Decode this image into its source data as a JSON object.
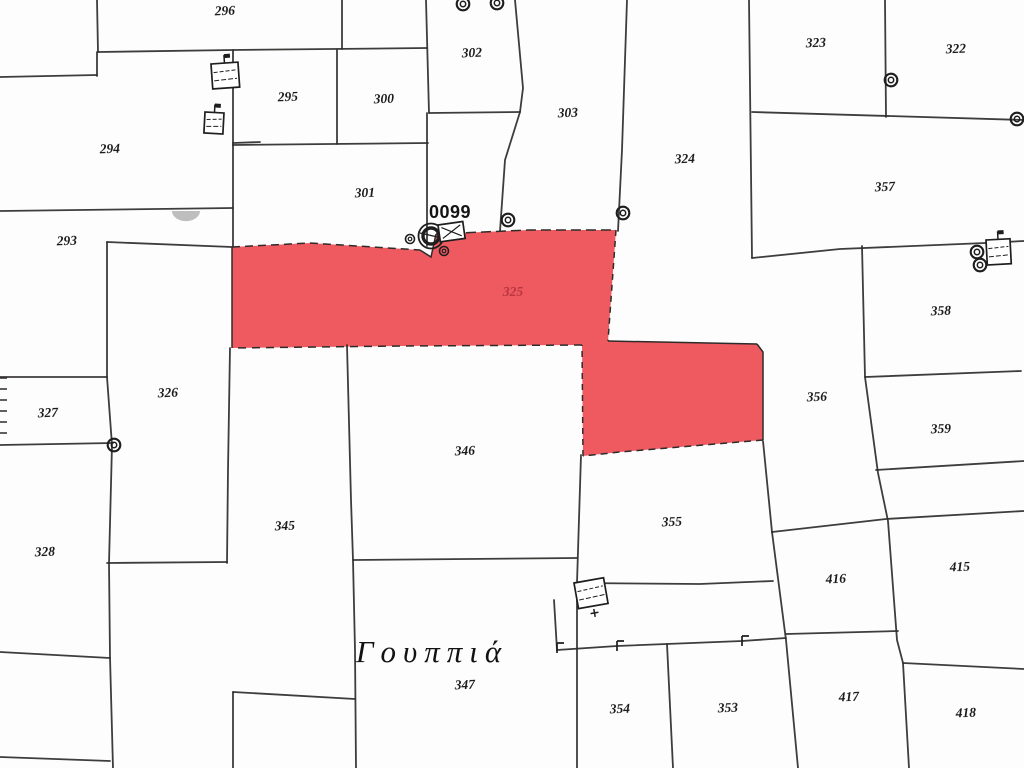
{
  "map": {
    "area_name": "Γουππιά",
    "reference_label": "0099",
    "highlight_parcel_number": "325",
    "colors": {
      "background": "#fdfdfd",
      "line": "#2e2c2a",
      "highlight_fill": "#ef5a61",
      "highlight_label": "#b9353f",
      "label": "#1c1c1c",
      "blob": "#b3b3b3"
    },
    "parcel_labels": [
      {
        "text": "296",
        "x": 225,
        "y": 15
      },
      {
        "text": "294",
        "x": 110,
        "y": 153
      },
      {
        "text": "293",
        "x": 67,
        "y": 245
      },
      {
        "text": "295",
        "x": 288,
        "y": 101
      },
      {
        "text": "300",
        "x": 384,
        "y": 103
      },
      {
        "text": "302",
        "x": 472,
        "y": 57
      },
      {
        "text": "303",
        "x": 568,
        "y": 117
      },
      {
        "text": "301",
        "x": 365,
        "y": 197
      },
      {
        "text": "324",
        "x": 685,
        "y": 163
      },
      {
        "text": "323",
        "x": 816,
        "y": 47
      },
      {
        "text": "322",
        "x": 956,
        "y": 53
      },
      {
        "text": "357",
        "x": 885,
        "y": 191
      },
      {
        "text": "358",
        "x": 941,
        "y": 315
      },
      {
        "text": "359",
        "x": 941,
        "y": 433
      },
      {
        "text": "356",
        "x": 817,
        "y": 401
      },
      {
        "text": "326",
        "x": 168,
        "y": 397
      },
      {
        "text": "327",
        "x": 48,
        "y": 417
      },
      {
        "text": "328",
        "x": 45,
        "y": 556
      },
      {
        "text": "345",
        "x": 285,
        "y": 530
      },
      {
        "text": "346",
        "x": 465,
        "y": 455
      },
      {
        "text": "355",
        "x": 672,
        "y": 526
      },
      {
        "text": "347",
        "x": 465,
        "y": 689
      },
      {
        "text": "354",
        "x": 620,
        "y": 713
      },
      {
        "text": "353",
        "x": 728,
        "y": 712
      },
      {
        "text": "415",
        "x": 960,
        "y": 571
      },
      {
        "text": "416",
        "x": 836,
        "y": 583
      },
      {
        "text": "417",
        "x": 849,
        "y": 701
      },
      {
        "text": "418",
        "x": 966,
        "y": 717
      }
    ],
    "special_labels": [
      {
        "type": "ref",
        "text": "0099",
        "x": 450,
        "y": 218
      },
      {
        "type": "highlight",
        "text": "325",
        "x": 513,
        "y": 296
      },
      {
        "type": "area",
        "text": "Γουππιά",
        "x": 432,
        "y": 662
      }
    ],
    "highlight": {
      "polygon": [
        [
          232,
          247
        ],
        [
          310,
          243
        ],
        [
          420,
          250
        ],
        [
          431,
          257
        ],
        [
          436,
          234
        ],
        [
          530,
          230
        ],
        [
          616,
          230
        ],
        [
          608,
          341
        ],
        [
          757,
          344
        ],
        [
          763,
          352
        ],
        [
          763,
          440
        ],
        [
          680,
          447
        ],
        [
          620,
          452
        ],
        [
          583,
          456
        ],
        [
          582,
          345
        ],
        [
          400,
          346
        ],
        [
          232,
          348
        ]
      ],
      "edges": [
        {
          "pts": [
            [
              232,
              247
            ],
            [
              310,
              243
            ],
            [
              420,
              250
            ]
          ],
          "dash": "8 5"
        },
        {
          "pts": [
            [
              420,
              250
            ],
            [
              431,
              257
            ],
            [
              436,
              234
            ]
          ],
          "dash": ""
        },
        {
          "pts": [
            [
              436,
              234
            ],
            [
              530,
              230
            ],
            [
              616,
              230
            ]
          ],
          "dash": "10 5"
        },
        {
          "pts": [
            [
              616,
              230
            ],
            [
              608,
              341
            ]
          ],
          "dash": "6 5"
        },
        {
          "pts": [
            [
              608,
              341
            ],
            [
              757,
              344
            ]
          ],
          "dash": ""
        },
        {
          "pts": [
            [
              757,
              344
            ],
            [
              763,
              352
            ],
            [
              763,
              440
            ]
          ],
          "dash": ""
        },
        {
          "pts": [
            [
              763,
              440
            ],
            [
              680,
              447
            ],
            [
              620,
              452
            ],
            [
              583,
              456
            ]
          ],
          "dash": "7 5"
        },
        {
          "pts": [
            [
              583,
              456
            ],
            [
              582,
              345
            ]
          ],
          "dash": "6 5"
        },
        {
          "pts": [
            [
              582,
              345
            ],
            [
              400,
              346
            ],
            [
              232,
              348
            ]
          ],
          "dash": "8 6"
        },
        {
          "pts": [
            [
              232,
              348
            ],
            [
              232,
              247
            ]
          ],
          "dash": ""
        }
      ]
    },
    "lines": [
      {
        "pts": [
          [
            97,
            0
          ],
          [
            98,
            52
          ]
        ]
      },
      {
        "pts": [
          [
            98,
            52
          ],
          [
            233,
            50
          ],
          [
            427,
            48
          ]
        ]
      },
      {
        "pts": [
          [
            0,
            77
          ],
          [
            97,
            75
          ]
        ]
      },
      {
        "pts": [
          [
            97,
            52
          ],
          [
            97,
            76
          ]
        ]
      },
      {
        "pts": [
          [
            342,
            0
          ],
          [
            342,
            49
          ]
        ]
      },
      {
        "pts": [
          [
            233,
            50
          ],
          [
            233,
            145
          ]
        ]
      },
      {
        "pts": [
          [
            233,
            145
          ],
          [
            428,
            143
          ]
        ]
      },
      {
        "pts": [
          [
            337,
            50
          ],
          [
            337,
            144
          ]
        ]
      },
      {
        "pts": [
          [
            426,
            0
          ],
          [
            429,
            113
          ]
        ]
      },
      {
        "pts": [
          [
            429,
            113
          ],
          [
            520,
            112
          ]
        ]
      },
      {
        "pts": [
          [
            515,
            0
          ],
          [
            523,
            88
          ],
          [
            520,
            112
          ]
        ]
      },
      {
        "pts": [
          [
            427,
            113
          ],
          [
            427,
            246
          ]
        ]
      },
      {
        "pts": [
          [
            233,
            145
          ],
          [
            233,
            246
          ]
        ]
      },
      {
        "pts": [
          [
            520,
            112
          ],
          [
            505,
            160
          ],
          [
            500,
            231
          ]
        ]
      },
      {
        "pts": [
          [
            627,
            0
          ],
          [
            622,
            150
          ],
          [
            618,
            231
          ]
        ]
      },
      {
        "pts": [
          [
            749,
            0
          ],
          [
            752,
            258
          ]
        ]
      },
      {
        "pts": [
          [
            885,
            0
          ],
          [
            886,
            117
          ]
        ]
      },
      {
        "pts": [
          [
            752,
            112
          ],
          [
            1024,
            120
          ]
        ]
      },
      {
        "pts": [
          [
            752,
            258
          ],
          [
            840,
            249
          ],
          [
            985,
            243
          ],
          [
            1024,
            241
          ]
        ]
      },
      {
        "pts": [
          [
            862,
            246
          ],
          [
            865,
            377
          ],
          [
            878,
            473
          ],
          [
            888,
            521
          ],
          [
            897,
            640
          ],
          [
            903,
            663
          ],
          [
            909,
            768
          ]
        ]
      },
      {
        "pts": [
          [
            865,
            377
          ],
          [
            1021,
            371
          ]
        ]
      },
      {
        "pts": [
          [
            876,
            470
          ],
          [
            1024,
            461
          ]
        ]
      },
      {
        "pts": [
          [
            772,
            532
          ],
          [
            886,
            519
          ],
          [
            1024,
            511
          ]
        ]
      },
      {
        "pts": [
          [
            903,
            663
          ],
          [
            1024,
            669
          ]
        ]
      },
      {
        "pts": [
          [
            786,
            634
          ],
          [
            898,
            631
          ]
        ]
      },
      {
        "pts": [
          [
            772,
            532
          ],
          [
            786,
            640
          ],
          [
            798,
            768
          ]
        ]
      },
      {
        "pts": [
          [
            763,
            441
          ],
          [
            772,
            532
          ]
        ]
      },
      {
        "pts": [
          [
            0,
            211
          ],
          [
            233,
            208
          ]
        ]
      },
      {
        "pts": [
          [
            107,
            242
          ],
          [
            232,
            247
          ]
        ]
      },
      {
        "pts": [
          [
            107,
            242
          ],
          [
            107,
            377
          ],
          [
            112,
            445
          ],
          [
            109,
            563
          ],
          [
            110,
            657
          ],
          [
            113,
            768
          ]
        ]
      },
      {
        "pts": [
          [
            0,
            377
          ],
          [
            107,
            377
          ]
        ]
      },
      {
        "pts": [
          [
            0,
            445
          ],
          [
            113,
            443
          ]
        ]
      },
      {
        "pts": [
          [
            0,
            652
          ],
          [
            110,
            658
          ]
        ]
      },
      {
        "pts": [
          [
            0,
            757
          ],
          [
            110,
            761
          ]
        ]
      },
      {
        "pts": [
          [
            107,
            563
          ],
          [
            227,
            562
          ]
        ]
      },
      {
        "pts": [
          [
            230,
            348
          ],
          [
            228,
            470
          ],
          [
            227,
            563
          ]
        ]
      },
      {
        "pts": [
          [
            233,
            692
          ],
          [
            355,
            699
          ]
        ]
      },
      {
        "pts": [
          [
            233,
            692
          ],
          [
            233,
            768
          ]
        ]
      },
      {
        "pts": [
          [
            347,
            345
          ],
          [
            351,
            500
          ],
          [
            353,
            560
          ],
          [
            355,
            650
          ],
          [
            356,
            768
          ]
        ]
      },
      {
        "pts": [
          [
            353,
            560
          ],
          [
            577,
            558
          ]
        ]
      },
      {
        "pts": [
          [
            578,
            583
          ],
          [
            700,
            584
          ],
          [
            773,
            581
          ]
        ]
      },
      {
        "pts": [
          [
            581,
            455
          ],
          [
            577,
            583
          ],
          [
            577,
            768
          ]
        ]
      },
      {
        "pts": [
          [
            554,
            600
          ],
          [
            557,
            650
          ]
        ]
      },
      {
        "pts": [
          [
            557,
            650
          ],
          [
            617,
            646
          ],
          [
            742,
            641
          ],
          [
            786,
            638
          ]
        ]
      },
      {
        "pts": [
          [
            667,
            644
          ],
          [
            673,
            768
          ]
        ]
      },
      {
        "pts": [
          [
            233,
            143
          ],
          [
            260,
            142
          ]
        ]
      }
    ],
    "wells": [
      {
        "x": 463,
        "y": 4,
        "kind": "small"
      },
      {
        "x": 497,
        "y": 3,
        "kind": "small"
      },
      {
        "x": 508,
        "y": 220,
        "kind": "small"
      },
      {
        "x": 623,
        "y": 213,
        "kind": "small"
      },
      {
        "x": 891,
        "y": 80,
        "kind": "small"
      },
      {
        "x": 1017,
        "y": 119,
        "kind": "small"
      },
      {
        "x": 114,
        "y": 445,
        "kind": "small"
      },
      {
        "x": 977,
        "y": 252,
        "kind": "small"
      },
      {
        "x": 980,
        "y": 265,
        "kind": "small"
      },
      {
        "x": 431,
        "y": 236,
        "kind": "large"
      },
      {
        "x": 410,
        "y": 239,
        "kind": "tiny"
      },
      {
        "x": 444,
        "y": 251,
        "kind": "tiny"
      }
    ],
    "structures": [
      {
        "x": 211,
        "y": 64,
        "w": 27,
        "h": 25,
        "rot": -4,
        "deco": "flag"
      },
      {
        "x": 205,
        "y": 112,
        "w": 19,
        "h": 21,
        "rot": 3,
        "deco": "flag"
      },
      {
        "x": 986,
        "y": 240,
        "w": 24,
        "h": 25,
        "rot": -3,
        "deco": "flag"
      },
      {
        "x": 574,
        "y": 583,
        "w": 30,
        "h": 26,
        "rot": -10,
        "deco": "cross"
      },
      {
        "x": 438,
        "y": 225,
        "w": 25,
        "h": 17,
        "rot": -8,
        "deco": "x"
      }
    ],
    "ticks": [
      {
        "x": 617,
        "y": 647
      },
      {
        "x": 742,
        "y": 642
      },
      {
        "x": 557,
        "y": 649
      }
    ],
    "edge_hatch": {
      "x": 0,
      "len": 7,
      "ys": [
        378,
        389,
        400,
        411,
        422,
        433
      ]
    },
    "blobs": [
      {
        "x": 186,
        "y": 211,
        "r": 14
      }
    ]
  }
}
